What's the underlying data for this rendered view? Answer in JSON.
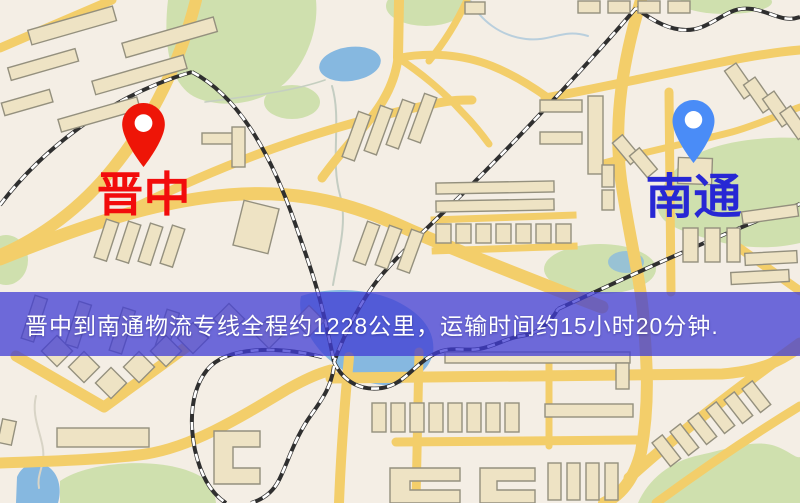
{
  "map_overlay": {
    "banner": {
      "text": "晋中到南通物流专线全程约1228公里，运输时间约15小时20分钟.",
      "background_color": "#403cd4",
      "text_color": "#ffffff"
    },
    "markers": [
      {
        "id": "origin",
        "label": "晋中",
        "icon": "red-location-pin-icon",
        "pin_color": "#ee1507",
        "label_color": "#f20c0c"
      },
      {
        "id": "destination",
        "label": "南通",
        "icon": "blue-location-pin-icon",
        "pin_color": "#4a8cf7",
        "label_color": "#2727d4"
      }
    ],
    "route": {
      "origin": "晋中",
      "destination": "南通",
      "distance_text": "约1228公里",
      "duration_text": "约15小时20分钟"
    }
  },
  "map_palette": {
    "background": "#f4eee5",
    "road": "#f3ce6a",
    "park": "#cfe0ae",
    "water": "#86b8e0",
    "building": "#eee3c4",
    "railway": "#2f2f2f"
  }
}
